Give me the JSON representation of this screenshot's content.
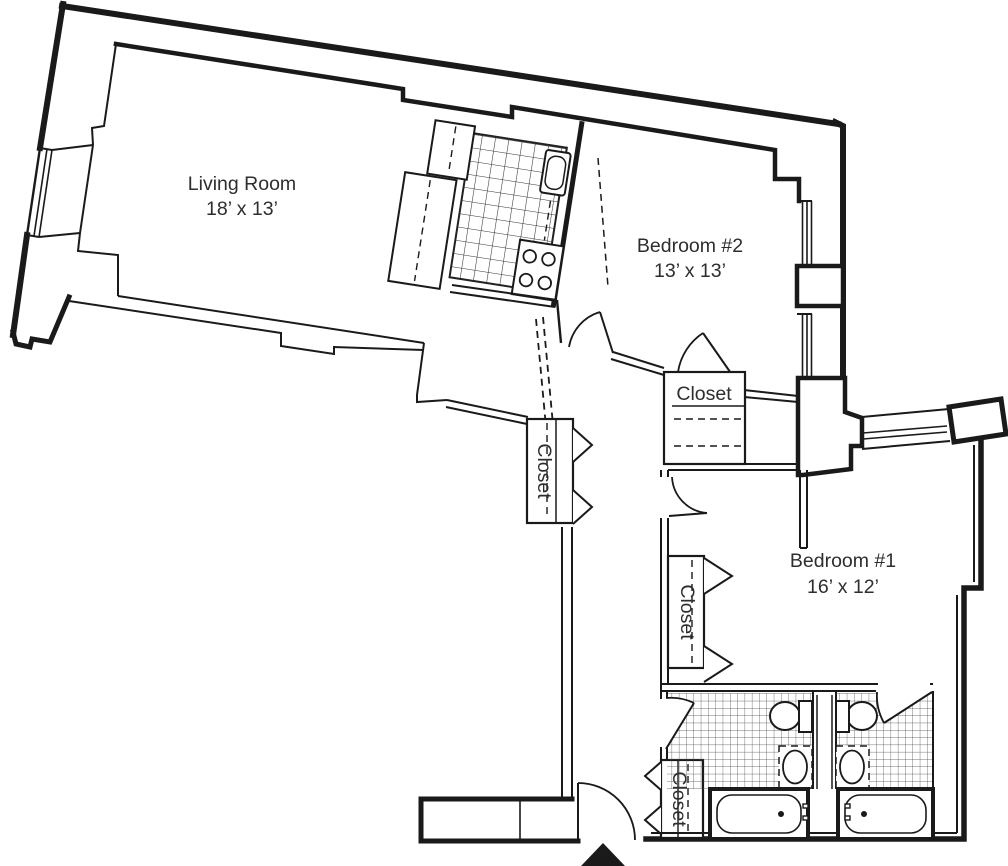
{
  "page": {
    "title": "Two-Bedroom Apartment Floor Plan",
    "background": "#ffffff",
    "wall_color": "#1a1a1a",
    "text_color": "#2e2e2e"
  },
  "rooms": {
    "living_room": {
      "label": "Living Room",
      "dims": "18’ x 13’"
    },
    "bedroom_2": {
      "label": "Bedroom #2",
      "dims": "13’ x 13’"
    },
    "bedroom_1": {
      "label": "Bedroom #1",
      "dims": "16’ x 12’"
    }
  },
  "closets": {
    "bedroom_2_closet": {
      "label": "Closet"
    },
    "hall_closet": {
      "label": "Closet"
    },
    "bedroom_1_closet": {
      "label": "Closet"
    },
    "entry_closet": {
      "label": "Closet"
    }
  },
  "fixture_names": [
    "kitchen-sink",
    "range-burners",
    "refrigerator-counter",
    "upper-cabinet",
    "toilet",
    "vanity-sink",
    "bathtub",
    "window",
    "door-swing",
    "bifold-door",
    "entry-arrow",
    "tile-floor"
  ]
}
